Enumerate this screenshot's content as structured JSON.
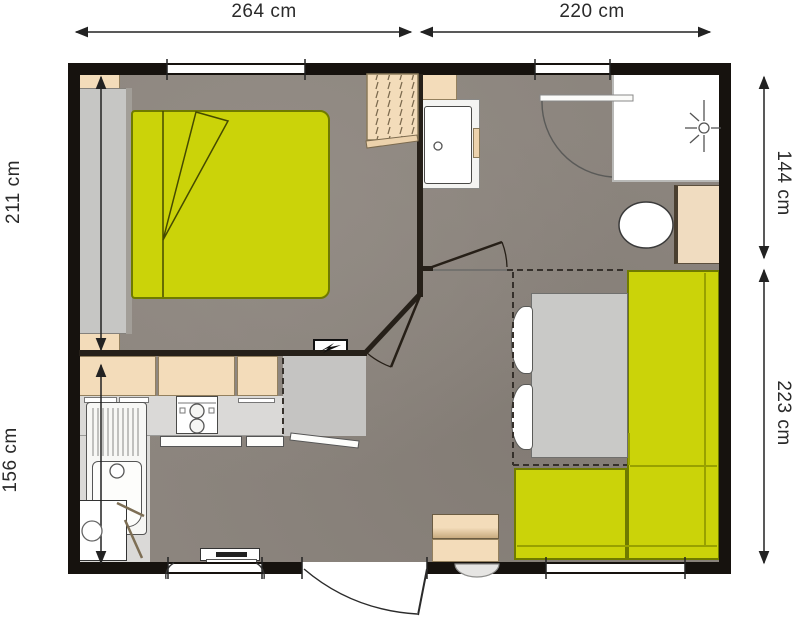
{
  "plan": {
    "type": "floorplan-mobile-home",
    "dimension_labels": {
      "top_left": "264 cm",
      "top_right": "220 cm",
      "left_upper": "211 cm",
      "left_lower": "156 cm",
      "right_upper": "144 cm",
      "right_lower": "223 cm"
    },
    "colors": {
      "accent_green": "#cbd309",
      "floor_taupe": "#8c857e",
      "furniture_tan": "#f3dcba",
      "wall_black": "#16120e",
      "fixture_white": "#ffffff"
    },
    "icons": [
      "lightning-bolt-icon",
      "shower-head-icon",
      "toilet-icon",
      "sink-faucet-icon",
      "cooktop-burners-icon"
    ]
  }
}
